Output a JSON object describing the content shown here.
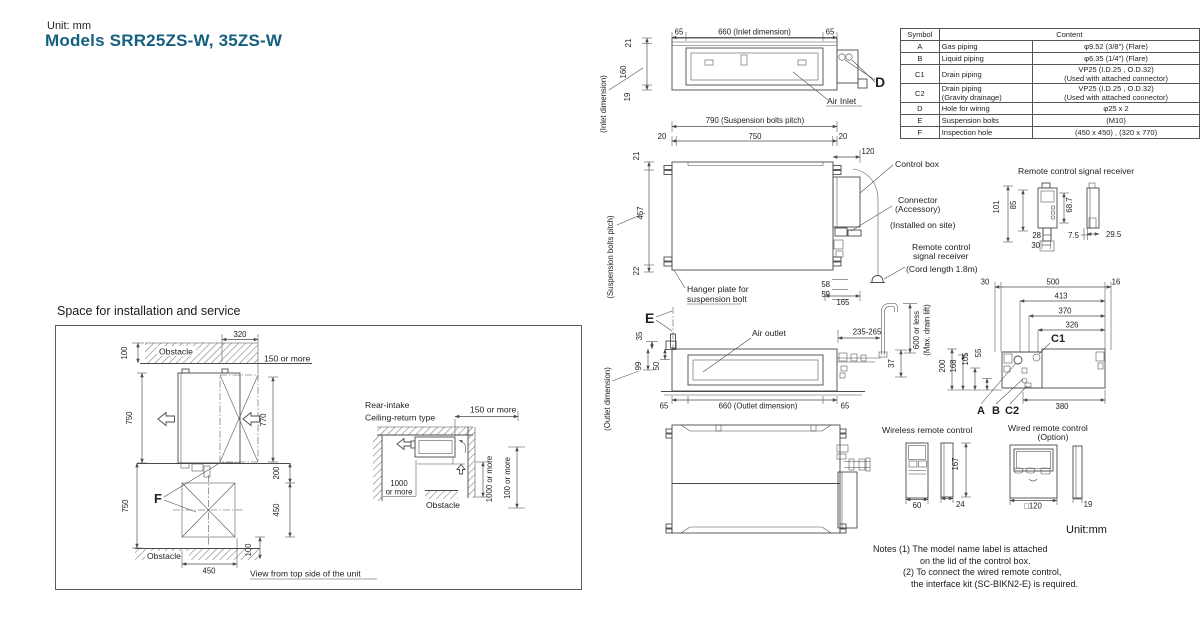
{
  "colors": {
    "accent_title": "#16607f",
    "line": "#4a4a4a",
    "text": "#222222"
  },
  "header": {
    "unit": "Unit: mm",
    "title": "Models SRR25ZS-W, 35ZS-W"
  },
  "spec_table": {
    "header_symbol": "Symbol",
    "header_content": "Content",
    "rows": [
      {
        "sym": "A",
        "item": "Gas piping",
        "item2": "",
        "val": "φ9.52 (3/8\") (Flare)",
        "val2": ""
      },
      {
        "sym": "B",
        "item": "Liquid piping",
        "item2": "",
        "val": "φ6.35 (1/4\") (Flare)",
        "val2": ""
      },
      {
        "sym": "C1",
        "item": "Drain piping",
        "item2": "",
        "val": "VP25 (I.D.25 , O.D.32)",
        "val2": "(Used with attached connector)"
      },
      {
        "sym": "C2",
        "item": "Drain piping",
        "item2": "(Gravity drainage)",
        "val": "VP25 (I.D.25 , O.D.32)",
        "val2": "(Used with attached connector)"
      },
      {
        "sym": "D",
        "item": "Hole for wiring",
        "item2": "",
        "val": "φ25 x 2",
        "val2": ""
      },
      {
        "sym": "E",
        "item": "Suspension bolts",
        "item2": "",
        "val": "(M10)",
        "val2": ""
      },
      {
        "sym": "F",
        "item": "Inspection hole",
        "item2": "",
        "val": "(450 x 450) , (320 x 770)",
        "val2": ""
      }
    ]
  },
  "install": {
    "title": "Space for installation and service",
    "top_view": {
      "d320": "320",
      "d100_top": "100",
      "obstacle_top": "Obstacle",
      "more150": "150 or more",
      "d750_top": "750",
      "d770": "770",
      "d200": "200",
      "f_mark": "F",
      "d750_bot": "750",
      "d450_r": "450",
      "d100_r": "100",
      "obstacle_bottom": "Obstacle",
      "d450_b": "450",
      "caption": "View from top side of the unit"
    },
    "side_view": {
      "title1": "Rear-intake",
      "title2": "Ceiling-return type",
      "more150": "150 or more",
      "more1000a": "1000",
      "more1000b": "or more",
      "obstacle": "Obstacle",
      "more1000_r": "1000 or more",
      "more100_r": "100 or more"
    }
  },
  "rear_view": {
    "d65l": "65",
    "d660": "660 (Inlet dimension)",
    "d65r": "65",
    "d21": "21",
    "d160": "160",
    "d19": "19",
    "inlet_dim": "(Inlet dimension)",
    "air_inlet": "Air Inlet",
    "d_mark": "D"
  },
  "plan_view": {
    "d790": "790 (Suspension bolts pitch)",
    "d20l": "20",
    "d750": "750",
    "d20r": "20",
    "d120": "120",
    "d21": "21",
    "d457": "457",
    "d22": "22",
    "pitch_label": "(Suspension bolts pitch)",
    "control_box": "Control box",
    "connector": "Connector",
    "accessory": "(Accessory)",
    "installed": "(Installed on site)",
    "rc1": "Remote control",
    "rc2": "signal receiver",
    "cord": "(Cord length 1.8m)",
    "hanger1": "Hanger plate for",
    "hanger2": "suspension bolt",
    "d58": "58",
    "d59": "59",
    "d165": "165"
  },
  "receiver": {
    "title": "Remote control signal receiver",
    "d101": "101",
    "d85": "85",
    "d687": "68.7",
    "d28": "28",
    "d30": "30",
    "d75": "7.5",
    "d295": "29.5"
  },
  "front_view": {
    "e_mark": "E",
    "air_outlet": "Air outlet",
    "d235": "235-265",
    "d37": "37",
    "d600": "600 or less",
    "maxdrain": "(Max. drain lift)",
    "d35": "35",
    "d99": "99",
    "d50": "50",
    "outlet_dim": "(Outlet dimension)",
    "d65l": "65",
    "d660": "660 (Outlet dimension)",
    "d65r": "65"
  },
  "side_view": {
    "d30": "30",
    "d500": "500",
    "d16": "16",
    "d413": "413",
    "d370": "370",
    "d326": "326",
    "c1": "C1",
    "a": "A",
    "b": "B",
    "c2": "C2",
    "d380": "380",
    "d200": "200",
    "d168": "168",
    "d105": "105",
    "d55": "55"
  },
  "wireless": {
    "title": "Wireless remote control",
    "d60": "60",
    "d24": "24",
    "d167": "167"
  },
  "wired": {
    "title": "Wired remote control",
    "option": "(Option)",
    "d120": "□120",
    "d19": "19"
  },
  "footer": {
    "unit": "Unit:mm",
    "notes": "Notes",
    "n1": "(1)",
    "n1a": "The model name label is attached",
    "n1b": "on the lid of the control box.",
    "n2": "(2)",
    "n2a": "To connect the wired remote control,",
    "n2b": "the interface kit (SC-BIKN2-E) is required."
  }
}
